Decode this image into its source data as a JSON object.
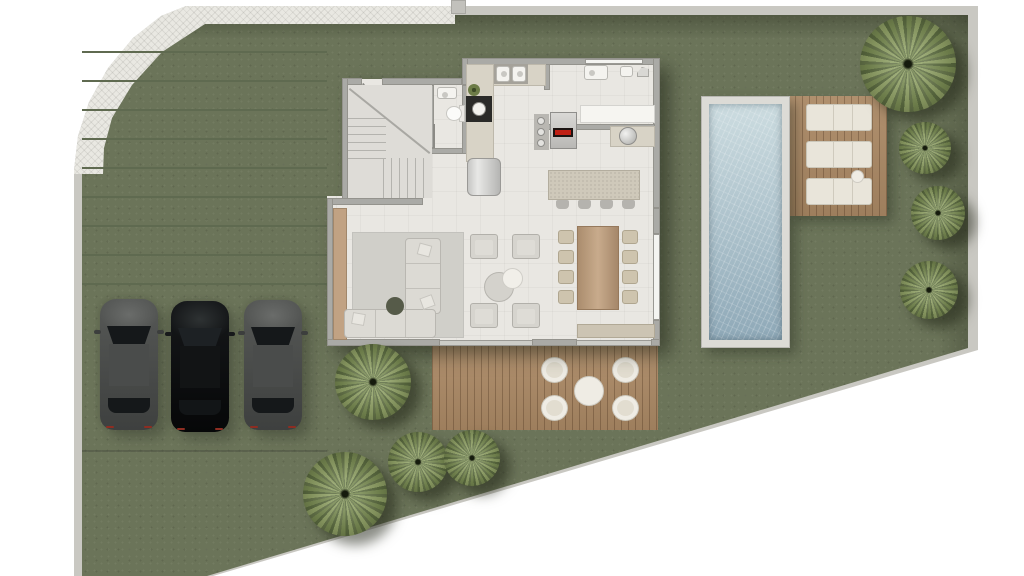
{
  "scene": {
    "description": "Top-down architectural site plan rendering of a single-family villa: driveway with three parked cars, entry hall with U-stair, bathroom, kitchen with island, laundry room, open living-dining room, rear wooden terrace with outdoor seating, lap pool with timber sun deck and three loungers, lawn with palm trees, herringbone public sidewalk at the curved street corner, and a diagonal lot boundary at the bottom right."
  },
  "counts": {
    "cars": 3,
    "palm_trees": 8,
    "sun_loungers": 3,
    "outdoor_tub_chairs": 4,
    "dining_chairs": 8,
    "bar_stools": 4,
    "armchairs": 4
  },
  "areas": [
    "sidewalk",
    "driveway",
    "parking-pad",
    "entry-hall",
    "staircase",
    "bathroom",
    "kitchen",
    "laundry-room",
    "living-room",
    "dining-area",
    "terrace-deck",
    "pool",
    "pool-deck",
    "lawn"
  ],
  "palette": {
    "outside": "#ffffff",
    "wallband": "#c9c8c2",
    "grass": "#6b7459",
    "joint": "#5f6a50",
    "concrete": "#d7d6d0",
    "sidewalk": "#e9e8e2",
    "floor": "#e9e7e2",
    "wall": "#aaaaa6",
    "woodDeck": "#ab8965",
    "woodTable": "#b79a7c",
    "waterLight": "#ccdce0",
    "waterDeep": "#8fa9b8",
    "poolCoping": "#dcdbd6",
    "whiteFurn": "#efece4",
    "sofa": "#dcdad4",
    "rug": "#d0cfc9",
    "counter": "#d8d3c6",
    "island": "#cfc9ba",
    "tanConsole": "#c1a283",
    "carGray": "#474947",
    "carBlack": "#0a0c0d",
    "glass": "#15181a",
    "foliageLight": "#8fa065",
    "foliageDark": "#5c6c41"
  }
}
